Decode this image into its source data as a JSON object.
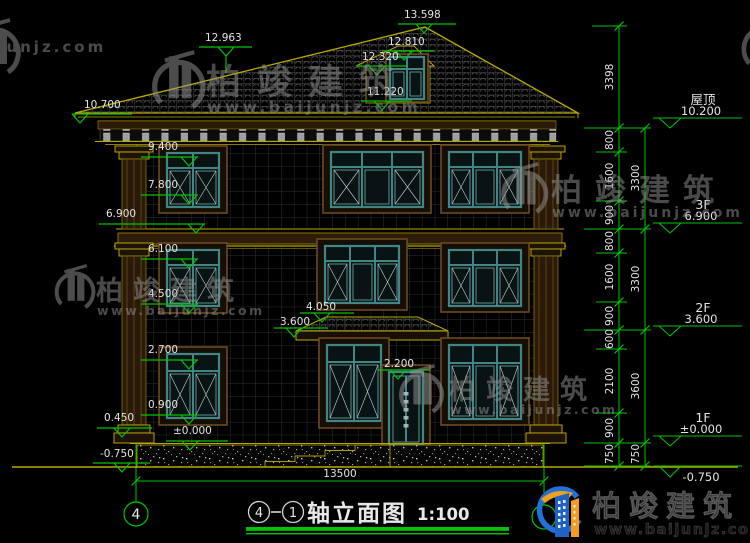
{
  "watermark": {
    "brand": "柏竣建筑",
    "url": "www.baijunjz.com"
  },
  "brand_logo": {
    "brand": "柏竣建筑",
    "url": "www.baijunjz.com"
  },
  "title": {
    "bubble_left": "4",
    "bubble_right": "1",
    "text": "轴立面图",
    "scale": "1:100"
  },
  "axis": {
    "left_bubble": "4",
    "span_dim": "13500"
  },
  "elevation_labels": {
    "top": [
      "13.598",
      "12.963",
      "12.810",
      "12.320",
      "11.220"
    ],
    "left": [
      "10.700",
      "9.400",
      "7.800",
      "6.900",
      "6.100",
      "4.500",
      "2.700",
      "0.900",
      "0.450",
      "±0.000",
      "-0.750"
    ],
    "mid": [
      "4.050",
      "3.600",
      "2.200"
    ]
  },
  "right_dims": {
    "inner": [
      "3398",
      "800",
      "1600",
      "900",
      "800",
      "1600",
      "900",
      "600",
      "2100",
      "900",
      "750"
    ],
    "outer": [
      "3300",
      "3300",
      "3600",
      "750"
    ]
  },
  "levels": [
    {
      "name": "屋顶",
      "value": "10.200"
    },
    {
      "name": "3F",
      "value": "6.900"
    },
    {
      "name": "2F",
      "value": "3.600"
    },
    {
      "name": "1F",
      "value": "±0.000"
    },
    {
      "name": "",
      "value": "-0.750"
    }
  ],
  "colors": {
    "dim_green": "#00c400",
    "cad_yellow": "#b8a800",
    "window_teal": "#418585",
    "text_white": "#e3e3e3"
  }
}
